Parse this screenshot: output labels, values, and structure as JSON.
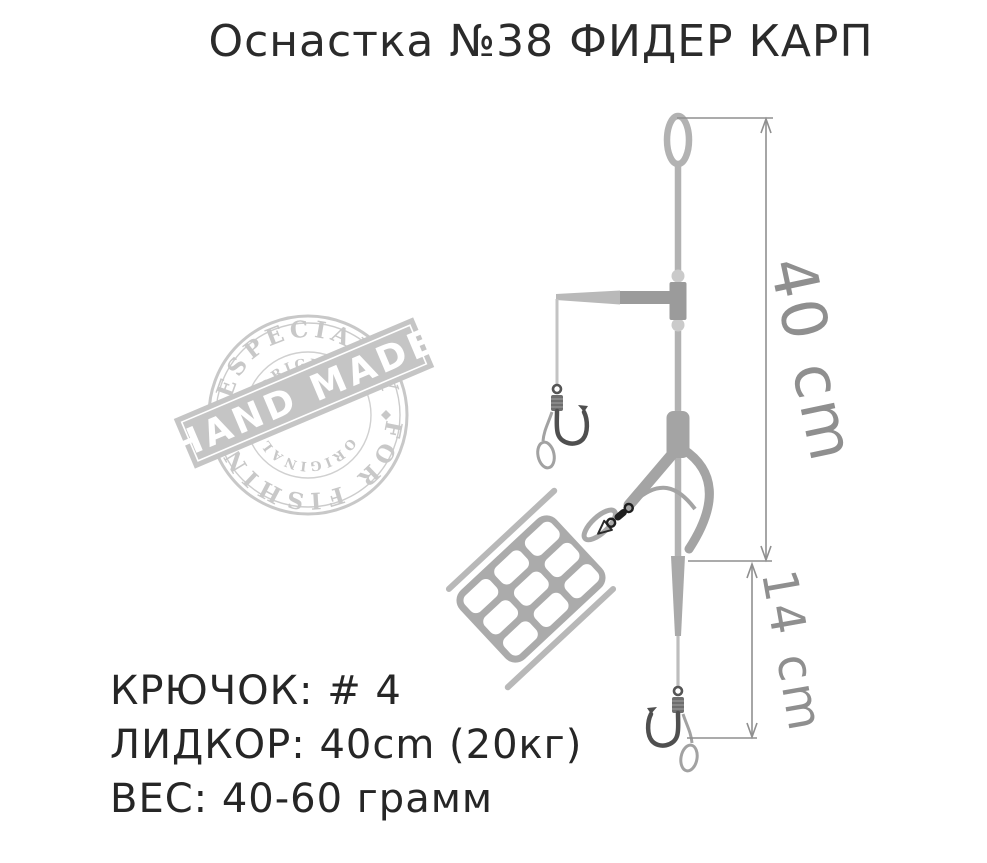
{
  "title": "Оснастка №38 ФИДЕР КАРП",
  "stamp": {
    "arc_top": "ESPECIALLY",
    "arc_bottom": "FOR FISHING",
    "inner_arc_top": "ORIGINAL",
    "inner_arc_bottom": "ORIGINAL",
    "banner": "HAND MADE"
  },
  "diagram": {
    "dim_main": "40 cm",
    "dim_tail": "14 cm"
  },
  "specs": {
    "hook": "КРЮЧОК: # 4",
    "leadcore": "ЛИДКОР: 40cm (20кг)",
    "weight": "ВЕС: 40-60 грамм"
  },
  "palette": {
    "line": "#b2b2b2",
    "fitting": "#9b9b9b",
    "branch": "#a4a4a4",
    "hook": "#4f4f4f",
    "swivel": "#1f1f1f",
    "dimension": "#8f8f8f",
    "stamp": "#c8c8c8",
    "text": "#262626"
  }
}
